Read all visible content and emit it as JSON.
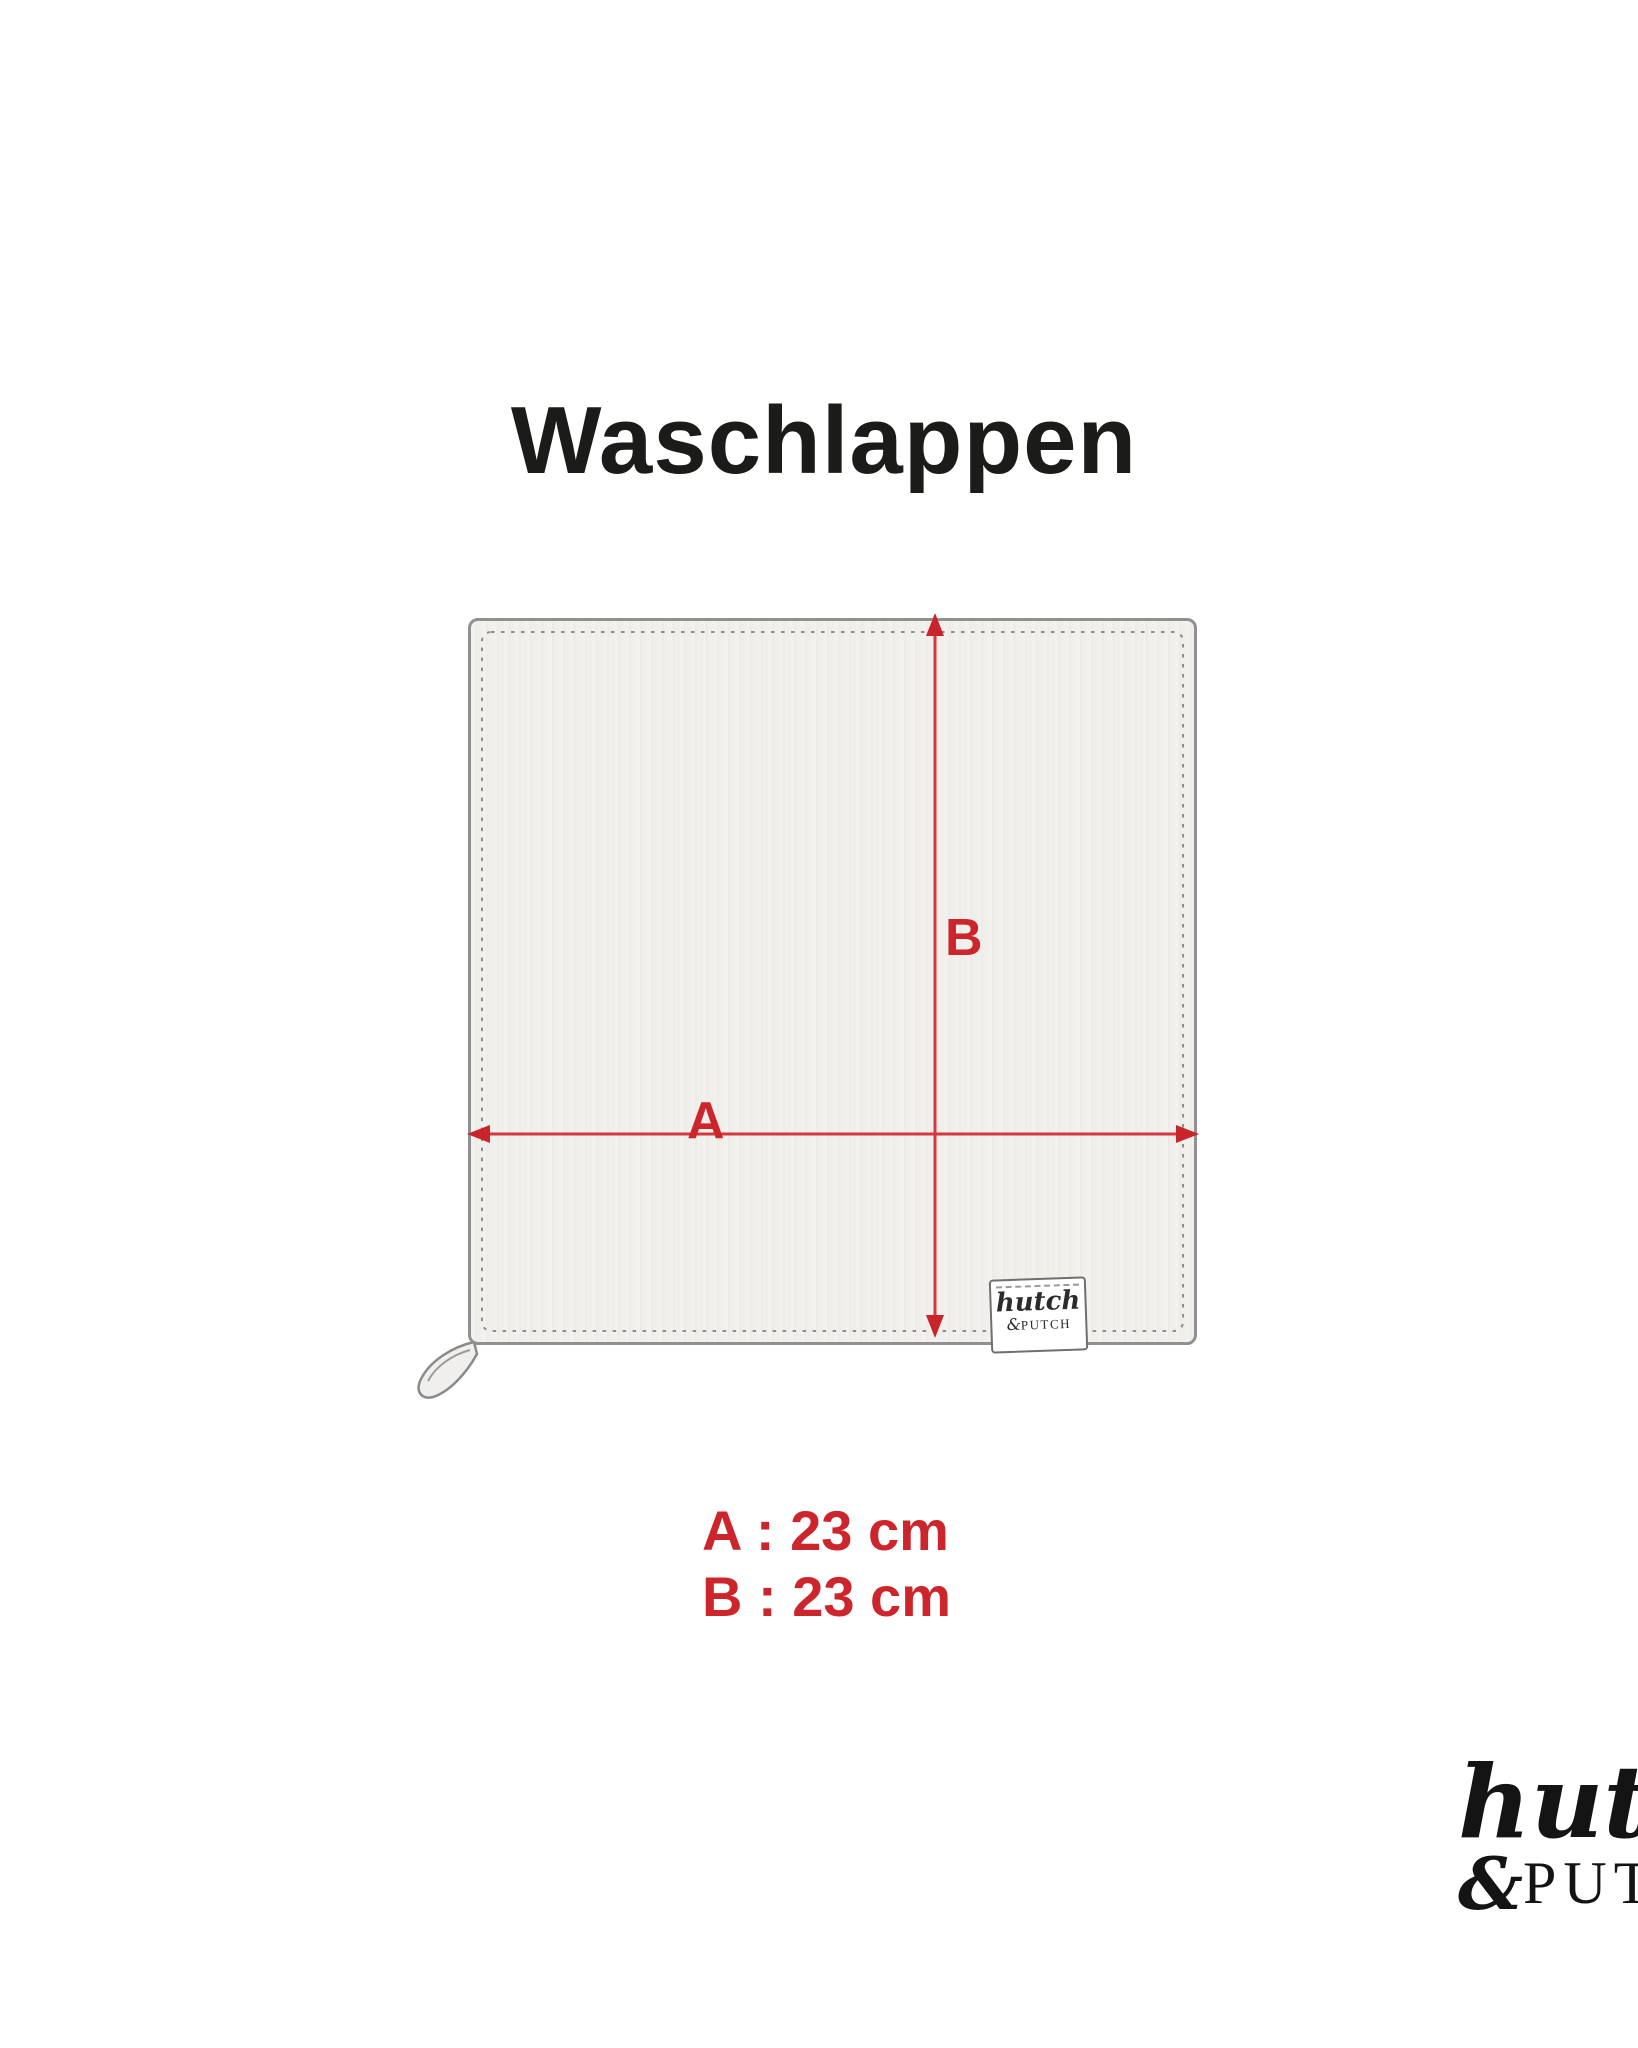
{
  "title": "Waschlappen",
  "diagram": {
    "dimension_label_a": "A",
    "dimension_label_b": "B",
    "tag": {
      "script": "hutch",
      "ampersand": "&",
      "caps": "PUTCH"
    }
  },
  "measurements": {
    "line_a": "A : 23 cm",
    "line_b": "B : 23 cm"
  },
  "brand_logo": {
    "script": "hutch",
    "ampersand": "&",
    "caps": "PUTCH"
  },
  "colors": {
    "accent_red": "#cc262c",
    "arrow_red": "#d2383d",
    "title_black": "#1b1b19",
    "fabric_fill": "#f1f0ee",
    "outline_gray": "#909090",
    "stitch_gray": "#8d8d8d"
  }
}
